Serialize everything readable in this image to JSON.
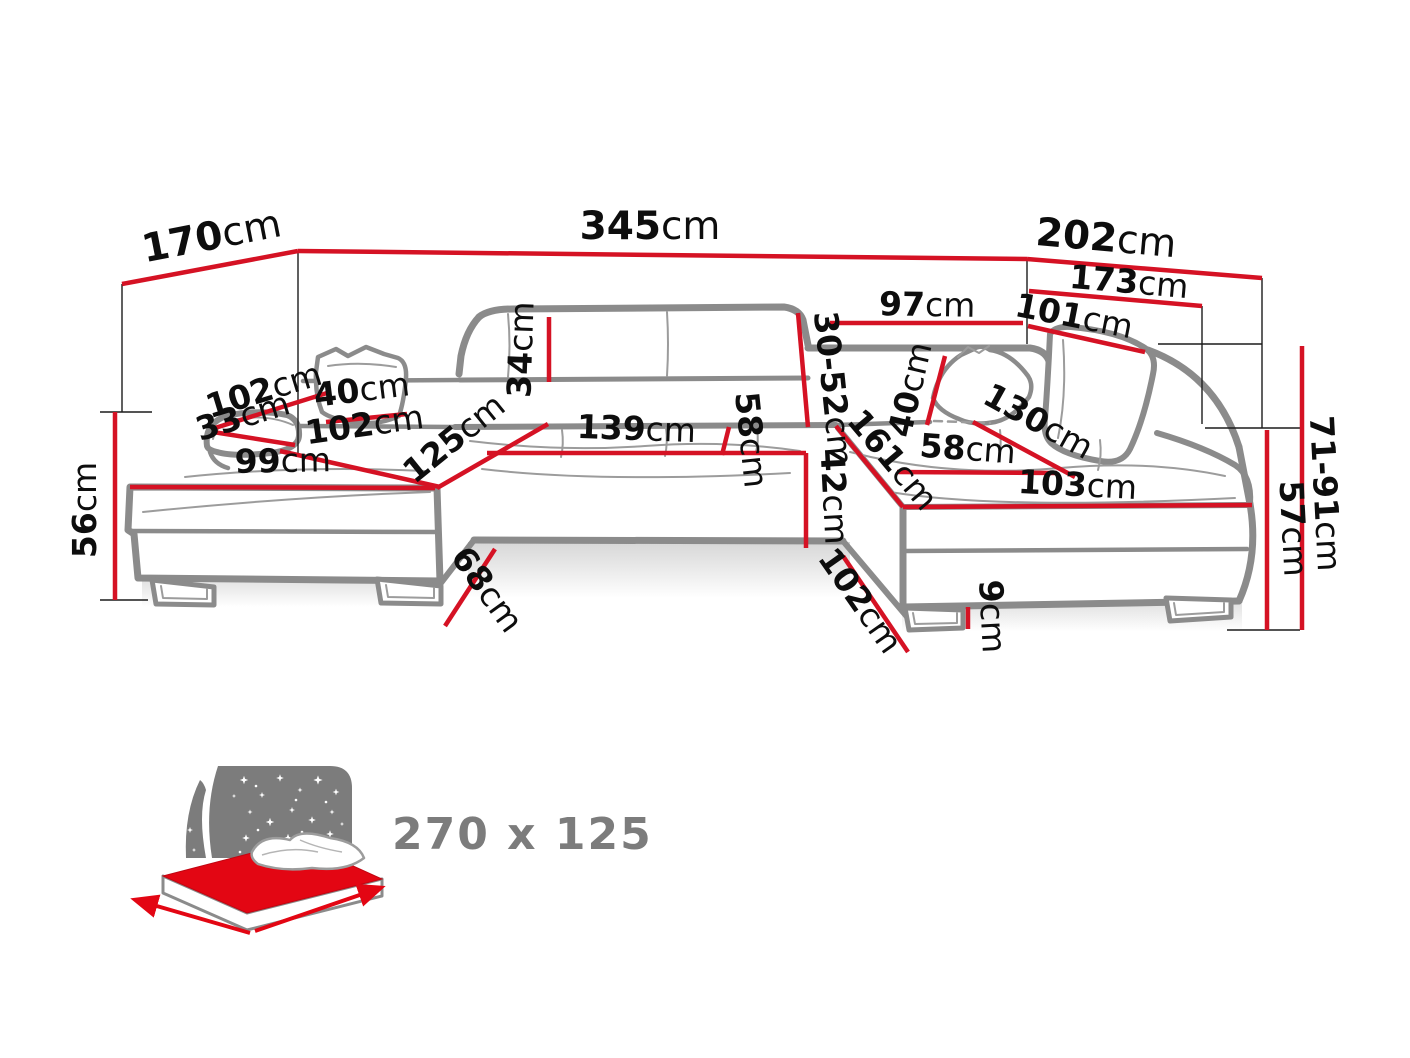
{
  "diagram": {
    "type": "furniture-dimension-diagram",
    "subject": "u-shaped-corner-sofa",
    "dimensions": {
      "d170": {
        "value": "170",
        "unit": "cm"
      },
      "d345": {
        "value": "345",
        "unit": "cm"
      },
      "d202": {
        "value": "202",
        "unit": "cm"
      },
      "d173": {
        "value": "173",
        "unit": "cm"
      },
      "d97": {
        "value": "97",
        "unit": "cm"
      },
      "d101": {
        "value": "101",
        "unit": "cm"
      },
      "d30_52": {
        "value": "30-52",
        "unit": "cm"
      },
      "d34": {
        "value": "34",
        "unit": "cm"
      },
      "d102_top": {
        "value": "102",
        "unit": "cm"
      },
      "d33": {
        "value": "33",
        "unit": "cm"
      },
      "d40_left": {
        "value": "40",
        "unit": "cm"
      },
      "d102_left": {
        "value": "102",
        "unit": "cm"
      },
      "d125": {
        "value": "125",
        "unit": "cm"
      },
      "d99": {
        "value": "99",
        "unit": "cm"
      },
      "d139": {
        "value": "139",
        "unit": "cm"
      },
      "d58_mid": {
        "value": "58",
        "unit": "cm"
      },
      "d42": {
        "value": "42",
        "unit": "cm"
      },
      "d161": {
        "value": "161",
        "unit": "cm"
      },
      "d58_right": {
        "value": "58",
        "unit": "cm"
      },
      "d103": {
        "value": "103",
        "unit": "cm"
      },
      "d130": {
        "value": "130",
        "unit": "cm"
      },
      "d40_right": {
        "value": "40",
        "unit": "cm"
      },
      "d68": {
        "value": "68",
        "unit": "cm"
      },
      "d102_bottom": {
        "value": "102",
        "unit": "cm"
      },
      "d9": {
        "value": "9",
        "unit": "cm"
      },
      "d56": {
        "value": "56",
        "unit": "cm"
      },
      "d71_91": {
        "value": "71-91",
        "unit": "cm"
      },
      "d57": {
        "value": "57",
        "unit": "cm"
      }
    },
    "sleeping_area": {
      "label": "270 x 125"
    }
  },
  "colors": {
    "dimension_line": "#d51224",
    "sofa_outline": "#8b8b8b",
    "icon_gray": "#7c7c7c",
    "mattress_red": "#e30613"
  }
}
